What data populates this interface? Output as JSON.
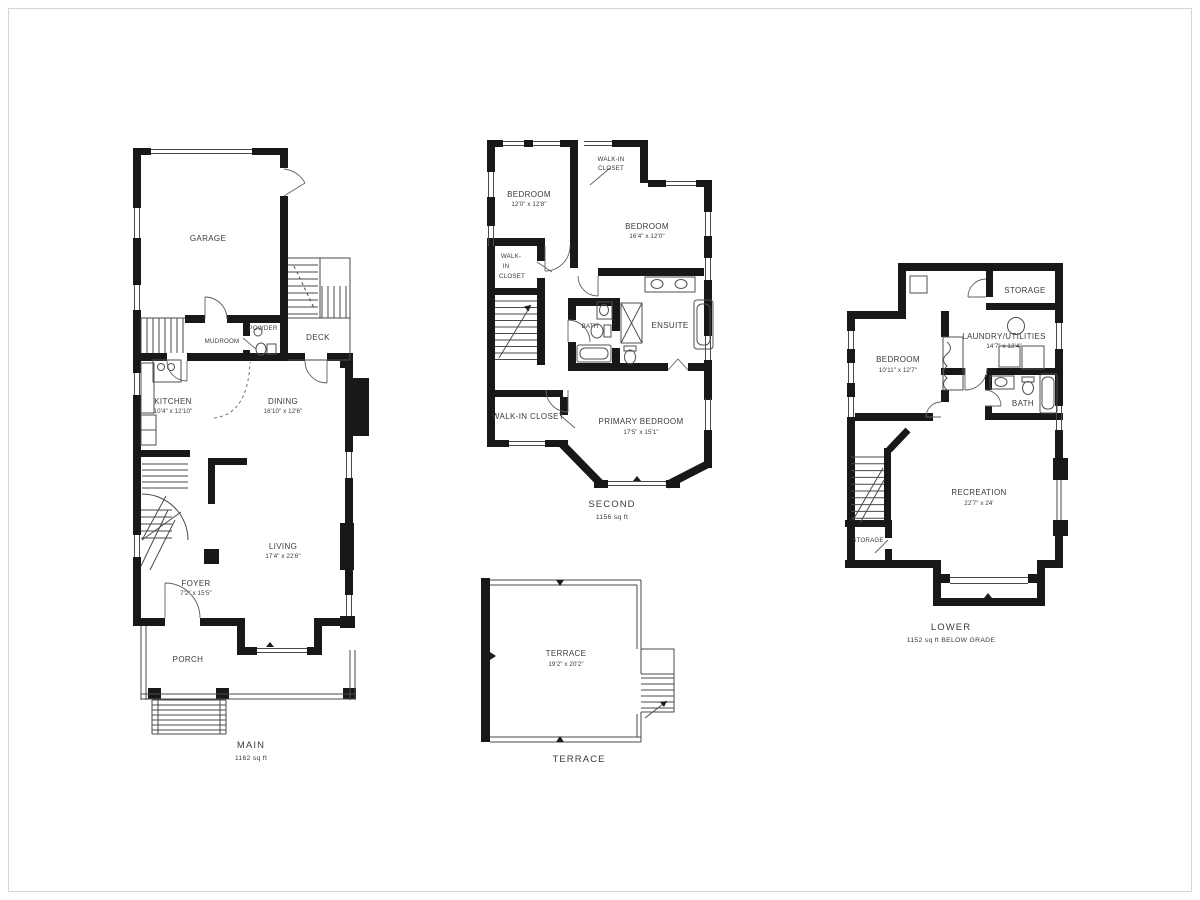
{
  "document": {
    "type": "residential floor plan, four plans on white sheet"
  },
  "palette": {
    "walls": "#181818",
    "thin_lines": "#4a4a4a",
    "text": "#3a3a3a",
    "background": "#ffffff"
  },
  "floors": {
    "main": {
      "caption": "MAIN",
      "area": "1162 sq ft",
      "rooms": {
        "garage": {
          "name": "GARAGE"
        },
        "mudroom": {
          "name": "MUDROOM"
        },
        "powder": {
          "name": "POWDER"
        },
        "deck": {
          "name": "DECK"
        },
        "kitchen": {
          "name": "KITCHEN",
          "dims": "10'4\" x 12'10\""
        },
        "dining": {
          "name": "DINING",
          "dims": "16'10\" x 12'6\""
        },
        "living": {
          "name": "LIVING",
          "dims": "17'4\" x 22'6\""
        },
        "foyer": {
          "name": "FOYER",
          "dims": "7'2\" x 15'5\""
        },
        "porch": {
          "name": "PORCH"
        }
      }
    },
    "second": {
      "caption": "SECOND",
      "area": "1156 sq ft",
      "rooms": {
        "bedroom1": {
          "name": "BEDROOM",
          "dims": "12'0\" x 12'8\""
        },
        "closet_top": {
          "line1": "WALK-IN",
          "line2": "CLOSET"
        },
        "bedroom2": {
          "name": "BEDROOM",
          "dims": "16'4\" x 12'0\""
        },
        "closet_left": {
          "line1": "WALK-",
          "line2": "IN",
          "line3": "CLOSET"
        },
        "bath": {
          "name": "BATH"
        },
        "ensuite": {
          "name": "ENSUITE"
        },
        "closet_bottom": {
          "name": "WALK-IN CLOSET"
        },
        "primary": {
          "name": "PRIMARY BEDROOM",
          "dims": "17'5\" x 15'1\""
        }
      }
    },
    "lower": {
      "caption": "LOWER",
      "area": "1152 sq ft BELOW GRADE",
      "rooms": {
        "storage_top": {
          "name": "STORAGE"
        },
        "laundry": {
          "name": "LAUNDRY/UTILITIES",
          "dims": "14'7\" x 12'4\""
        },
        "bedroom": {
          "name": "BEDROOM",
          "dims": "10'11\" x 12'7\""
        },
        "bath": {
          "name": "BATH"
        },
        "recreation": {
          "name": "RECREATION",
          "dims": "22'7\" x 24'"
        },
        "storage_bottom": {
          "name": "STORAGE"
        }
      }
    },
    "terrace": {
      "caption": "TERRACE",
      "rooms": {
        "terrace": {
          "name": "TERRACE",
          "dims": "19'2\" x 20'2\""
        }
      }
    }
  }
}
